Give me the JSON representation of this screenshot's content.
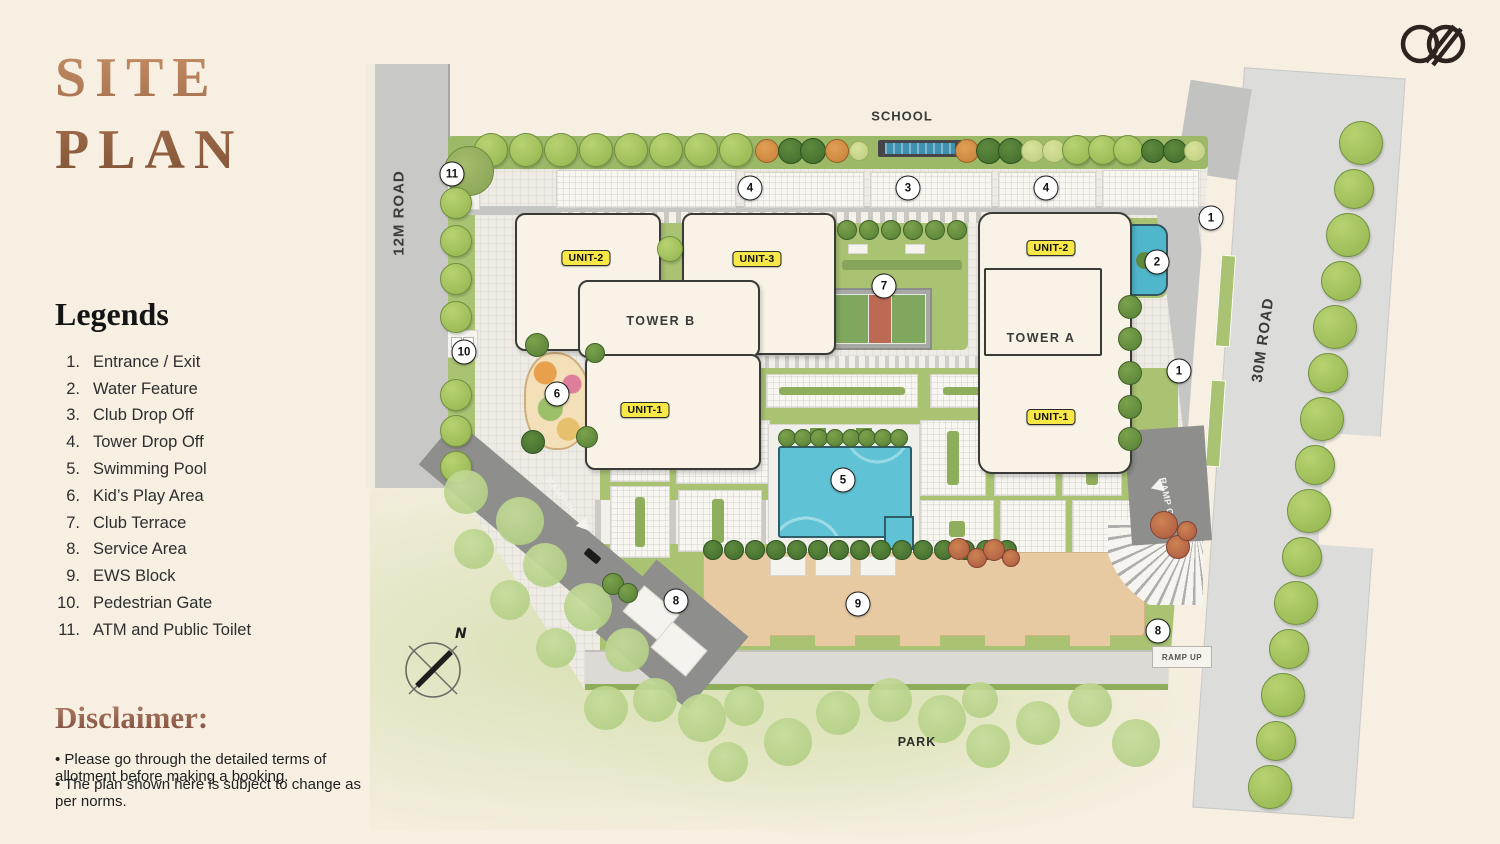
{
  "title": {
    "line1": "SITE",
    "line2": "PLAN"
  },
  "logo": {
    "icon": "interlocked-dd-monogram"
  },
  "legends": {
    "heading": "Legends",
    "items": [
      {
        "n": "1.",
        "label": "Entrance / Exit"
      },
      {
        "n": "2.",
        "label": "Water Feature"
      },
      {
        "n": "3.",
        "label": "Club Drop Off"
      },
      {
        "n": "4.",
        "label": "Tower Drop Off"
      },
      {
        "n": "5.",
        "label": "Swimming Pool"
      },
      {
        "n": "6.",
        "label": "Kid’s Play Area"
      },
      {
        "n": "7.",
        "label": "Club Terrace"
      },
      {
        "n": "8.",
        "label": "Service Area"
      },
      {
        "n": "9.",
        "label": "EWS Block"
      },
      {
        "n": "10.",
        "label": "Pedestrian Gate"
      },
      {
        "n": "11.",
        "label": "ATM and Public Toilet"
      }
    ]
  },
  "disclaimer": {
    "heading": "Disclaimer:",
    "bullets": [
      "• Please go through the detailed terms of allotment before making a booking.",
      "• The plan shown here is subject to change as per norms."
    ]
  },
  "plan": {
    "labels": {
      "school": "SCHOOL",
      "park": "PARK",
      "road_12m": "12M ROAD",
      "road_30m": "30M ROAD",
      "ramp_in": "RAMP IN",
      "ramp_out": "RAMP OUT",
      "ramp_up": "RAMP UP",
      "north": "N"
    },
    "towers": [
      "TOWER B",
      "TOWER A"
    ],
    "unit_labels": [
      "UNIT-2",
      "UNIT-3",
      "UNIT-1",
      "UNIT-2",
      "UNIT-1"
    ],
    "markers": [
      "11",
      "4",
      "3",
      "4",
      "1",
      "2",
      "7",
      "10",
      "1",
      "6",
      "5",
      "8",
      "9",
      "8"
    ],
    "colors": {
      "accent_copper": "#a9744a",
      "lawn_green": "#a9c373",
      "pool_blue": "#5fc3d5",
      "building_cream": "#f8f3e6",
      "road_gray": "#c6c6c4",
      "ews_tan": "#e7caa2",
      "badge_yellow": "#f7e747"
    }
  }
}
